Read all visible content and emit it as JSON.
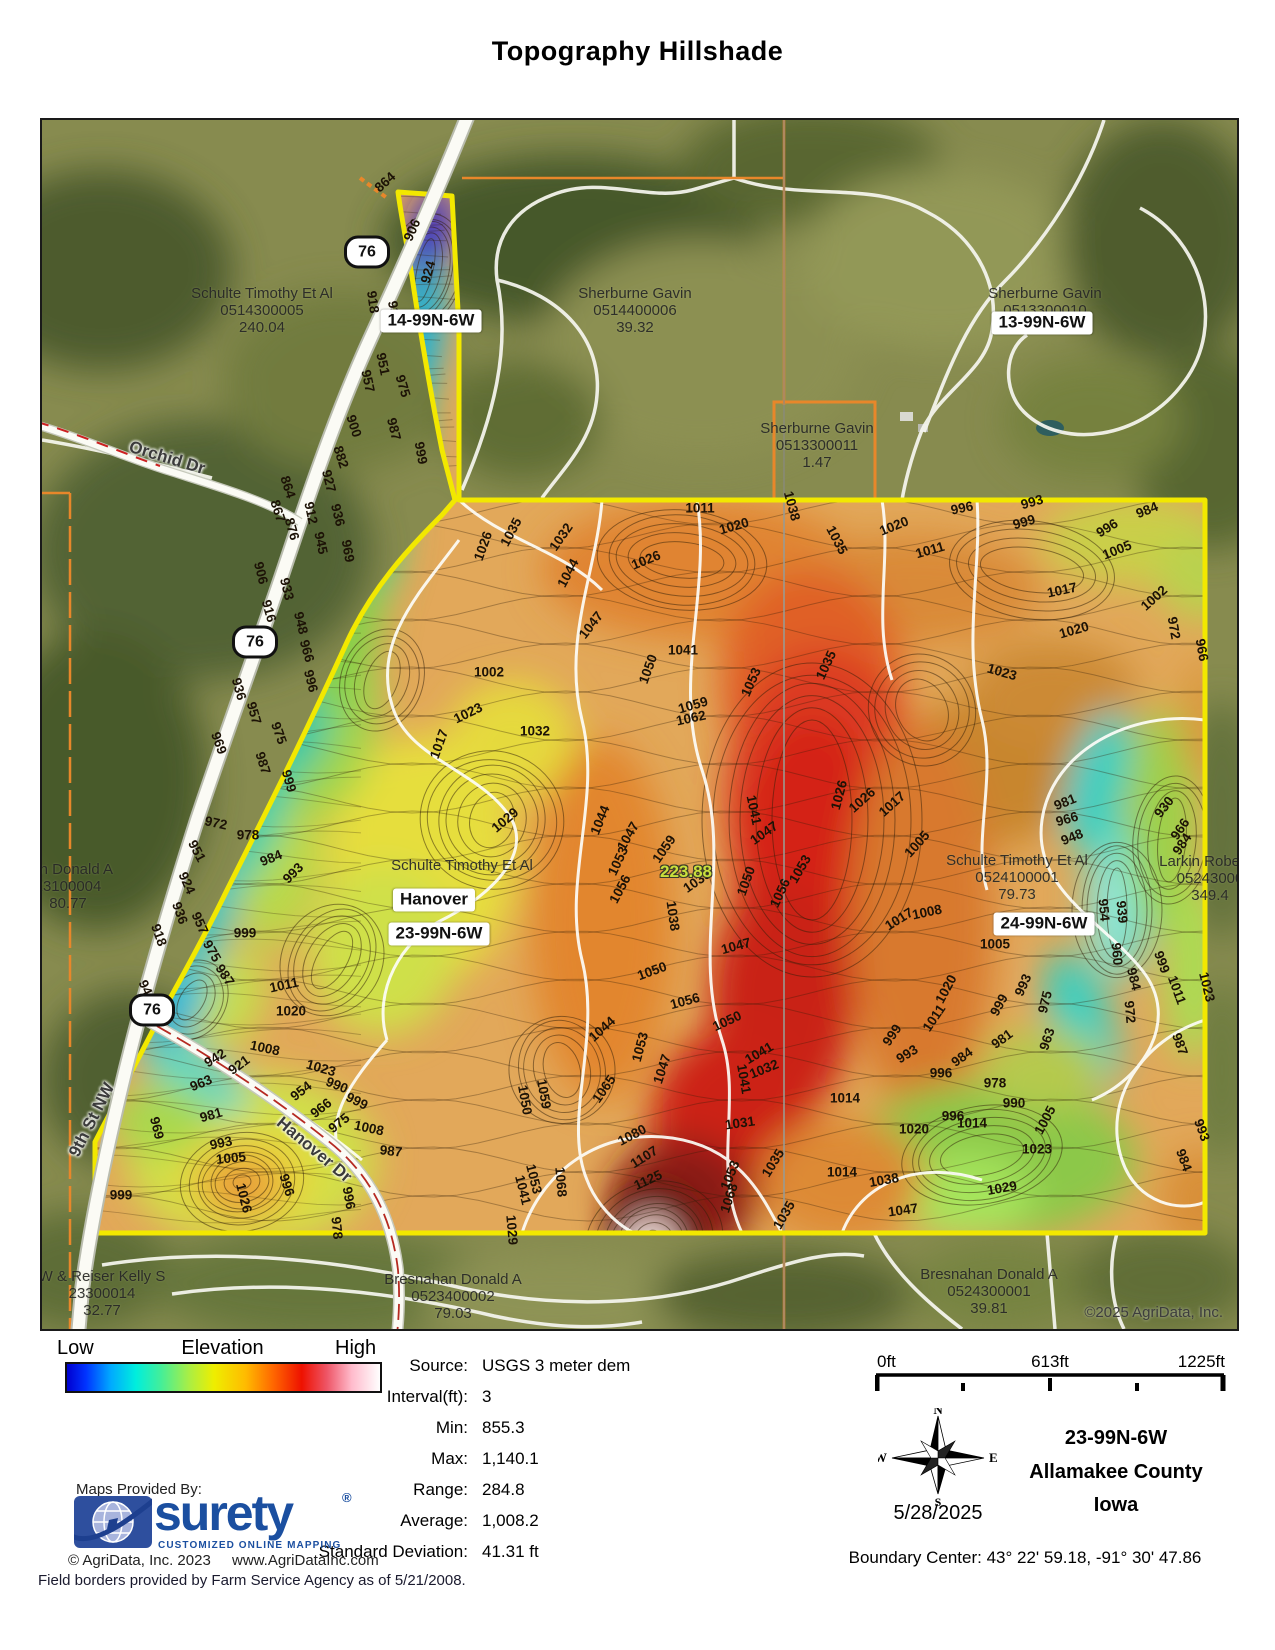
{
  "title": "Topography Hillshade",
  "map": {
    "copyright": "©2025 AgriData, Inc.",
    "route_shields": [
      {
        "label": "76",
        "x": 325,
        "y": 132
      },
      {
        "label": "76",
        "x": 213,
        "y": 522
      },
      {
        "label": "76",
        "x": 110,
        "y": 890
      }
    ],
    "road_labels": [
      {
        "text": "Orchid Dr",
        "x": 125,
        "y": 338,
        "rot": 17
      },
      {
        "text": "9th St NW",
        "x": 50,
        "y": 1000,
        "rot": -63
      },
      {
        "text": "Hanover Dr",
        "x": 272,
        "y": 1030,
        "rot": 40
      }
    ],
    "section_tags": [
      {
        "text": "14-99N-6W",
        "x": 389,
        "y": 201
      },
      {
        "text": "13-99N-6W",
        "x": 1000,
        "y": 203
      },
      {
        "text": "Hanover",
        "x": 392,
        "y": 780
      },
      {
        "text": "23-99N-6W",
        "x": 397,
        "y": 814
      },
      {
        "text": "24-99N-6W",
        "x": 1002,
        "y": 804
      }
    ],
    "area_tag": {
      "text": "223.88",
      "x": 644,
      "y": 752
    },
    "parcel_labels": [
      {
        "lines": [
          "Schulte Timothy Et Al",
          "0514300005",
          "240.04"
        ],
        "x": 220,
        "y": 165
      },
      {
        "lines": [
          "Sherburne Gavin",
          "0514400006",
          "39.32"
        ],
        "x": 593,
        "y": 165
      },
      {
        "lines": [
          "Sherburne Gavin",
          "0513300010"
        ],
        "x": 1003,
        "y": 165
      },
      {
        "lines": [
          "Sherburne Gavin",
          "0513300011",
          "1.47"
        ],
        "x": 775,
        "y": 300
      },
      {
        "lines": [
          "han Donald A",
          "23100004",
          "80.77"
        ],
        "x": 26,
        "y": 741
      },
      {
        "lines": [
          "W & Reiser Kelly S",
          "23300014",
          "32.77"
        ],
        "x": 60,
        "y": 1148
      },
      {
        "lines": [
          "Bresnahan Donald A",
          "0523400002",
          "79.03"
        ],
        "x": 411,
        "y": 1151
      },
      {
        "lines": [
          "Bresnahan Donald A",
          "0524300001",
          "39.81"
        ],
        "x": 947,
        "y": 1146
      },
      {
        "lines": [
          "Larkin Robert J",
          "05243000",
          "349.4"
        ],
        "x": 1168,
        "y": 733
      },
      {
        "lines": [
          "Schulte Timothy Et Al",
          "0524100001",
          "79.73"
        ],
        "x": 975,
        "y": 732
      },
      {
        "lines": [
          "Schulte Timothy Et Al"
        ],
        "x": 420,
        "y": 737
      }
    ],
    "contour_labels": [
      [
        864,
        343,
        62,
        -42
      ],
      [
        906,
        370,
        110,
        -66
      ],
      [
        924,
        386,
        152,
        -74
      ],
      [
        918,
        331,
        182,
        82
      ],
      [
        939,
        352,
        192,
        82
      ],
      [
        951,
        341,
        244,
        78
      ],
      [
        957,
        326,
        261,
        78
      ],
      [
        975,
        361,
        266,
        73
      ],
      [
        987,
        352,
        309,
        76
      ],
      [
        999,
        379,
        333,
        80
      ],
      [
        900,
        312,
        306,
        72
      ],
      [
        882,
        299,
        337,
        72
      ],
      [
        927,
        287,
        361,
        76
      ],
      [
        936,
        296,
        395,
        76
      ],
      [
        912,
        269,
        393,
        78
      ],
      [
        945,
        279,
        423,
        78
      ],
      [
        969,
        306,
        431,
        80
      ],
      [
        864,
        246,
        367,
        72
      ],
      [
        867,
        236,
        391,
        72
      ],
      [
        876,
        250,
        409,
        74
      ],
      [
        906,
        219,
        453,
        76
      ],
      [
        933,
        245,
        469,
        76
      ],
      [
        916,
        227,
        491,
        74
      ],
      [
        948,
        259,
        503,
        76
      ],
      [
        966,
        265,
        531,
        74
      ],
      [
        996,
        269,
        561,
        76
      ],
      [
        936,
        197,
        569,
        74
      ],
      [
        957,
        212,
        593,
        74
      ],
      [
        975,
        237,
        613,
        70
      ],
      [
        987,
        221,
        643,
        72
      ],
      [
        999,
        247,
        661,
        74
      ],
      [
        969,
        177,
        623,
        70
      ],
      [
        972,
        174,
        703,
        12
      ],
      [
        978,
        206,
        715,
        0
      ],
      [
        984,
        229,
        738,
        -22
      ],
      [
        993,
        251,
        753,
        -45
      ],
      [
        951,
        155,
        731,
        62
      ],
      [
        924,
        145,
        763,
        66
      ],
      [
        936,
        138,
        793,
        70
      ],
      [
        957,
        158,
        803,
        66
      ],
      [
        975,
        170,
        831,
        60
      ],
      [
        987,
        183,
        855,
        56
      ],
      [
        918,
        117,
        815,
        70
      ],
      [
        948,
        105,
        871,
        66
      ],
      [
        966,
        119,
        895,
        60
      ],
      [
        999,
        203,
        813,
        0
      ],
      [
        1011,
        242,
        865,
        -12
      ],
      [
        1020,
        249,
        891,
        0
      ],
      [
        1008,
        223,
        928,
        12
      ],
      [
        1023,
        279,
        948,
        16
      ],
      [
        990,
        295,
        965,
        22
      ],
      [
        999,
        315,
        981,
        26
      ],
      [
        1008,
        327,
        1008,
        12
      ],
      [
        987,
        349,
        1031,
        6
      ],
      [
        996,
        307,
        1078,
        80
      ],
      [
        978,
        295,
        1108,
        84
      ],
      [
        942,
        173,
        938,
        -32
      ],
      [
        963,
        159,
        963,
        -22
      ],
      [
        981,
        169,
        995,
        -16
      ],
      [
        969,
        115,
        1008,
        76
      ],
      [
        993,
        179,
        1023,
        -12
      ],
      [
        1005,
        189,
        1038,
        -6
      ],
      [
        1026,
        202,
        1078,
        76
      ],
      [
        996,
        245,
        1065,
        72
      ],
      [
        999,
        79,
        1075,
        0
      ],
      [
        921,
        197,
        945,
        -36
      ],
      [
        954,
        259,
        971,
        -38
      ],
      [
        966,
        279,
        988,
        -38
      ],
      [
        975,
        297,
        1003,
        -38
      ],
      [
        1011,
        658,
        388,
        0
      ],
      [
        1020,
        692,
        406,
        -16
      ],
      [
        1026,
        604,
        440,
        -22
      ],
      [
        1032,
        519,
        417,
        -55
      ],
      [
        1035,
        469,
        412,
        -62
      ],
      [
        1026,
        441,
        426,
        -70
      ],
      [
        1044,
        526,
        453,
        -62
      ],
      [
        1047,
        549,
        505,
        -52
      ],
      [
        1041,
        641,
        530,
        0
      ],
      [
        1050,
        606,
        549,
        -70
      ],
      [
        1053,
        709,
        562,
        -66
      ],
      [
        1059,
        651,
        585,
        -16
      ],
      [
        1062,
        649,
        598,
        -12
      ],
      [
        1032,
        493,
        611,
        0
      ],
      [
        1023,
        426,
        593,
        -26
      ],
      [
        1002,
        447,
        552,
        0
      ],
      [
        1017,
        397,
        624,
        -70
      ],
      [
        1029,
        463,
        700,
        -40
      ],
      [
        1044,
        558,
        700,
        -68
      ],
      [
        1047,
        586,
        716,
        -60
      ],
      [
        1053,
        576,
        741,
        -65
      ],
      [
        1056,
        578,
        769,
        -62
      ],
      [
        1041,
        712,
        690,
        78
      ],
      [
        1047,
        722,
        713,
        -35
      ],
      [
        1050,
        704,
        761,
        -70
      ],
      [
        1056,
        738,
        773,
        -65
      ],
      [
        1035,
        655,
        761,
        -35
      ],
      [
        1038,
        631,
        796,
        82
      ],
      [
        1047,
        694,
        826,
        -15
      ],
      [
        1053,
        758,
        749,
        -60
      ],
      [
        1059,
        622,
        729,
        -55
      ],
      [
        1050,
        685,
        901,
        -25
      ],
      [
        1056,
        643,
        881,
        -15
      ],
      [
        1044,
        560,
        909,
        -42
      ],
      [
        1050,
        610,
        851,
        -20
      ],
      [
        1041,
        717,
        933,
        -30
      ],
      [
        1032,
        722,
        949,
        -22
      ],
      [
        1031,
        698,
        1003,
        -8
      ],
      [
        1041,
        702,
        959,
        80
      ],
      [
        1035,
        731,
        1043,
        -58
      ],
      [
        1053,
        688,
        1055,
        -68
      ],
      [
        1080,
        590,
        1015,
        -28
      ],
      [
        1107,
        602,
        1037,
        -32
      ],
      [
        1125,
        606,
        1060,
        -25
      ],
      [
        1068,
        519,
        1062,
        85
      ],
      [
        1068,
        687,
        1078,
        -72
      ],
      [
        1065,
        562,
        969,
        -55
      ],
      [
        1053,
        598,
        927,
        -75
      ],
      [
        1047,
        620,
        949,
        -72
      ],
      [
        1059,
        502,
        974,
        80
      ],
      [
        1050,
        483,
        980,
        80
      ],
      [
        1029,
        470,
        1110,
        85
      ],
      [
        1041,
        481,
        1070,
        76
      ],
      [
        1053,
        492,
        1059,
        76
      ],
      [
        1038,
        750,
        386,
        75
      ],
      [
        1035,
        795,
        420,
        62
      ],
      [
        1020,
        852,
        406,
        -22
      ],
      [
        1011,
        888,
        430,
        -16
      ],
      [
        996,
        920,
        388,
        -12
      ],
      [
        993,
        990,
        382,
        -16
      ],
      [
        999,
        982,
        402,
        -16
      ],
      [
        984,
        1105,
        390,
        -22
      ],
      [
        996,
        1065,
        408,
        -32
      ],
      [
        1005,
        1075,
        430,
        -22
      ],
      [
        1017,
        1020,
        470,
        -12
      ],
      [
        1002,
        1112,
        478,
        -42
      ],
      [
        1020,
        1032,
        510,
        -16
      ],
      [
        1023,
        960,
        552,
        16
      ],
      [
        972,
        1132,
        508,
        80
      ],
      [
        966,
        1160,
        530,
        80
      ],
      [
        1035,
        784,
        545,
        -65
      ],
      [
        1026,
        797,
        675,
        -75
      ],
      [
        1017,
        850,
        684,
        -42
      ],
      [
        1005,
        875,
        724,
        -48
      ],
      [
        1008,
        885,
        792,
        -12
      ],
      [
        1017,
        857,
        799,
        -32
      ],
      [
        1026,
        820,
        680,
        -42
      ],
      [
        1020,
        904,
        869,
        -62
      ],
      [
        1011,
        892,
        898,
        -56
      ],
      [
        999,
        850,
        915,
        -56
      ],
      [
        993,
        865,
        934,
        -32
      ],
      [
        984,
        920,
        937,
        -36
      ],
      [
        981,
        960,
        919,
        -36
      ],
      [
        1005,
        953,
        824,
        0
      ],
      [
        993,
        981,
        865,
        -66
      ],
      [
        999,
        957,
        885,
        -62
      ],
      [
        963,
        1005,
        919,
        -72
      ],
      [
        975,
        1003,
        882,
        -76
      ],
      [
        981,
        1023,
        682,
        -22
      ],
      [
        966,
        1025,
        699,
        -16
      ],
      [
        948,
        1030,
        717,
        -22
      ],
      [
        930,
        1122,
        687,
        -52
      ],
      [
        966,
        1138,
        709,
        -56
      ],
      [
        984,
        1140,
        724,
        -56
      ],
      [
        954,
        1062,
        790,
        85
      ],
      [
        939,
        1080,
        792,
        85
      ],
      [
        960,
        1075,
        834,
        85
      ],
      [
        984,
        1092,
        859,
        76
      ],
      [
        972,
        1088,
        892,
        85
      ],
      [
        999,
        1120,
        842,
        70
      ],
      [
        1011,
        1135,
        870,
        70
      ],
      [
        987,
        1138,
        924,
        70
      ],
      [
        1023,
        1165,
        867,
        76
      ],
      [
        978,
        953,
        963,
        0
      ],
      [
        990,
        972,
        983,
        0
      ],
      [
        996,
        911,
        996,
        0
      ],
      [
        1005,
        1003,
        1000,
        -62
      ],
      [
        1014,
        803,
        978,
        0
      ],
      [
        1020,
        872,
        1009,
        0
      ],
      [
        1014,
        930,
        1003,
        0
      ],
      [
        1023,
        995,
        1029,
        0
      ],
      [
        1029,
        960,
        1068,
        -10
      ],
      [
        1038,
        842,
        1060,
        -10
      ],
      [
        1047,
        861,
        1090,
        -8
      ],
      [
        996,
        899,
        953,
        0
      ],
      [
        984,
        1142,
        1040,
        70
      ],
      [
        993,
        1160,
        1010,
        70
      ],
      [
        1035,
        742,
        1095,
        -60
      ],
      [
        1014,
        800,
        1052,
        0
      ]
    ]
  },
  "legend": {
    "low": "Low",
    "title": "Elevation",
    "high": "High",
    "gradient": [
      "#0000d0 0%",
      "#0033ff 6%",
      "#00aaff 14%",
      "#00eedd 22%",
      "#44ee99 30%",
      "#aaee44 39%",
      "#eeee00 47%",
      "#ffbb00 57%",
      "#ff6600 66%",
      "#ee1100 75%",
      "#ee5566 83%",
      "#ffbbcc 91%",
      "#ffffff 100%"
    ]
  },
  "stats": {
    "rows": [
      {
        "label": "Source:",
        "value": "USGS 3 meter dem"
      },
      {
        "label": "Interval(ft):",
        "value": "3"
      },
      {
        "label": "Min:",
        "value": "855.3"
      },
      {
        "label": "Max:",
        "value": "1,140.1"
      },
      {
        "label": "Range:",
        "value": "284.8"
      },
      {
        "label": "Average:",
        "value": "1,008.2"
      },
      {
        "label": "Standard Deviation:",
        "value": "41.31 ft"
      }
    ]
  },
  "scalebar": {
    "start": "0ft",
    "mid": "613ft",
    "end": "1225ft"
  },
  "compass": {
    "n": "N",
    "e": "E",
    "s": "S",
    "w": "W",
    "date": "5/28/2025"
  },
  "location": {
    "township": "23-99N-6W",
    "county": "Allamakee County",
    "state": "Iowa",
    "boundary_center": "Boundary Center: 43° 22' 59.18,  -91° 30' 47.86"
  },
  "footer": {
    "provided_by": "Maps Provided By:",
    "brand": "surety",
    "brand_reg": "®",
    "brand_tagline": "CUSTOMIZED ONLINE MAPPING",
    "copyright": "© AgriData, Inc. 2023",
    "website": "www.AgriDataInc.com",
    "field_note": "Field borders provided by Farm Service Agency as of 5/21/2008."
  }
}
